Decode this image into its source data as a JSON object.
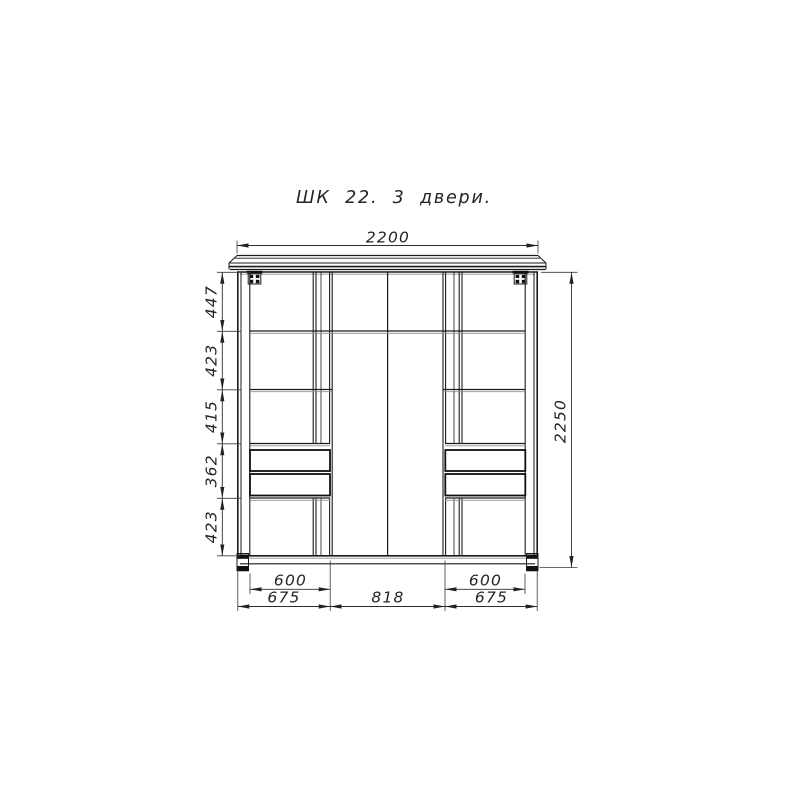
{
  "title": "ШК 22. 3 двери.",
  "dims": {
    "width_top": "2200",
    "height_right": "2250",
    "left_chain": [
      "447",
      "423",
      "415",
      "362",
      "423"
    ],
    "bottom_inner_widths": [
      "600",
      "600"
    ],
    "bottom_door_widths": [
      "675",
      "818",
      "675"
    ]
  },
  "colors": {
    "line": "#1b1b1b",
    "dimension": "#2e2e2e",
    "background": "#ffffff"
  }
}
